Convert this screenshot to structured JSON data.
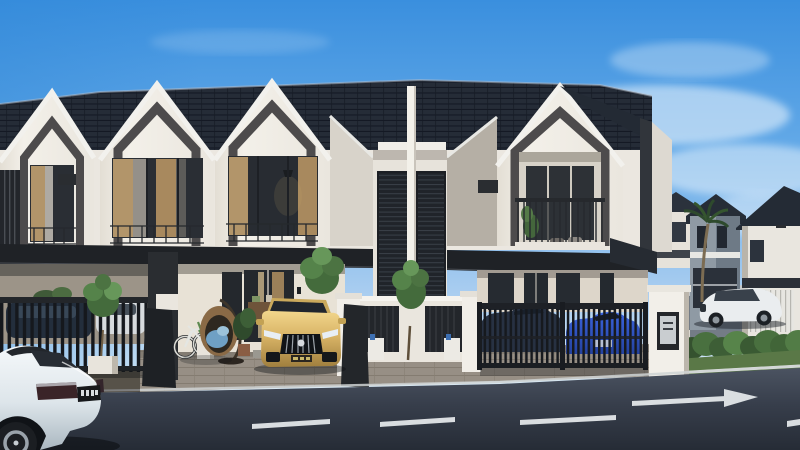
{
  "scene": {
    "type": "3d-architectural-render",
    "description": "Sunny exterior rendering of a modern white two-storey terrace-house row with charcoal tiled roofs and dark arched gable frames; landscaped driveways with parked cars, a dark asphalt street in front and more houses along a side street to the right.",
    "sky": {
      "condition": "clear blue with soft clouds",
      "top_color": "#3a8fde",
      "horizon_color": "#eef6fc"
    }
  },
  "palette": {
    "roof": "#242b36",
    "facade_white": "#f1eee7",
    "gable_frame_dark": "#4d4b4c",
    "eave_band": "#1f2226",
    "curtain_tan": "#b2956a",
    "glass_dark": "#262b31",
    "paving": "#968f85",
    "asphalt": "#2c333e",
    "hedge_green": "#49703f",
    "gold_car": "#d9b466",
    "blue_car": "#2f55cc",
    "marking_white": "#e8ecee"
  },
  "buildings": {
    "main_row": {
      "storeys": 2,
      "visible_units": 4,
      "style": "white gabled facades with dark pointed-arch frames",
      "features": [
        "charcoal tiled roof",
        "tan curtained picture windows",
        "vertical slat privacy screen on left unit",
        "balcony with seating on end unit",
        "covered car porches",
        "metal driveway gates"
      ]
    },
    "middle_bay": {
      "features": [
        "tall louvered stair windows",
        "white party-wall fin",
        "white horizontal rail"
      ]
    },
    "background": {
      "houses": 3,
      "features": [
        "white and grey walls",
        "dark roofs",
        "striped garage door",
        "palm tree"
      ],
      "street": "side street receding to the right"
    }
  },
  "vehicles": [
    {
      "name": "white-sedan-foreground",
      "color": "#e9eef2",
      "location": "street, bottom-left, seen from rear-right",
      "license_plate": {
        "visible": true,
        "legible": false
      }
    },
    {
      "name": "gold-sports-sedan",
      "color": "#d9b466",
      "location": "driveway of unit 2, facing the street",
      "license_plate": {
        "visible": true,
        "legible": false
      }
    },
    {
      "name": "dark-car-behind-left-fence",
      "color": "#232e3c",
      "location": "car porch of unit 1"
    },
    {
      "name": "white-car-behind-left-fence",
      "color": "#d9dde0",
      "location": "car porch of unit 1"
    },
    {
      "name": "navy-sedan-behind-gate",
      "color": "#273142",
      "location": "gated driveway of end unit"
    },
    {
      "name": "blue-sports-car-behind-gate",
      "color": "#2f55cc",
      "location": "gated driveway of end unit"
    },
    {
      "name": "white-luxury-sedan-background",
      "color": "#eaedef",
      "location": "background street, right"
    }
  ],
  "street": {
    "surface": "dark asphalt",
    "curb": "light concrete",
    "markings": {
      "center_dashes": 3,
      "turn_arrow": "right-pointing",
      "corner_dash": 1
    }
  },
  "landscaping": [
    "potted tree with white planter",
    "courtyard trees",
    "green hedge row",
    "lawn strip",
    "palm tree"
  ],
  "objects": [
    "hanging rattan egg chair with blue cushions",
    "white bicycle",
    "yucca in white planter",
    "terracotta potted plant",
    "utility meter boxes",
    "mailbox pillar",
    "vertical-bar driveway gates"
  ]
}
